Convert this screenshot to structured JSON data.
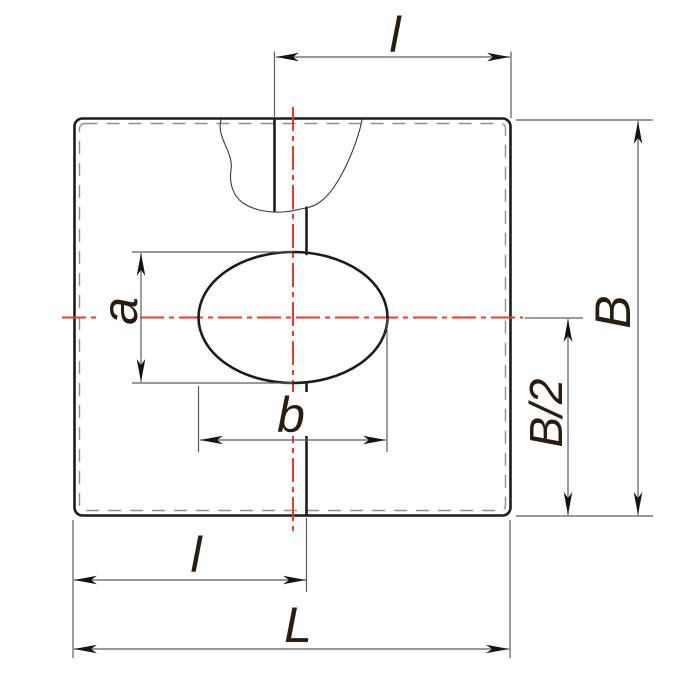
{
  "drawing": {
    "type": "engineering-dimension-drawing",
    "description": "Clamp plate with central elliptical hole and saw-cut slit, shown with break lines and centerlines",
    "labels": {
      "top_length": "l",
      "width_full": "B",
      "width_half": "B/2",
      "hole_height": "a",
      "hole_width": "b",
      "bottom_length": "l",
      "total_length": "L"
    },
    "colors": {
      "background": "#ffffff",
      "outline": "#1c1c1c",
      "dimension_lines": "#5c5c5c",
      "hidden_edge_dashed": "#8f8f8f",
      "centerline_red": "#ee3a2e",
      "label_text": "#2a1d10"
    }
  }
}
